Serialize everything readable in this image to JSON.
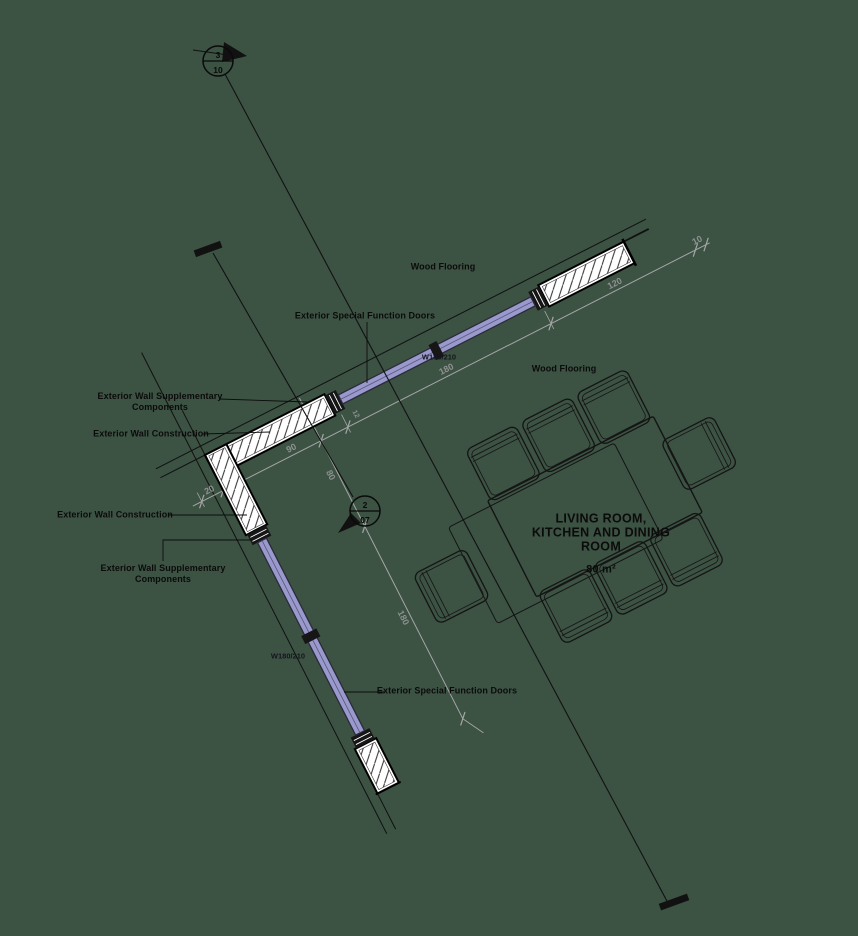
{
  "background": "#3c5243",
  "colors": {
    "background": "#3c5243",
    "door": "#9a99cd",
    "wall_fill": "#ffffff",
    "line": "#000000",
    "dimension": "#a6a6a6"
  },
  "room": {
    "title": [
      "LIVING ROOM,",
      "KITCHEN AND DINING",
      "ROOM"
    ],
    "area": "80 m²"
  },
  "labels": {
    "wood_flooring_top": "Wood Flooring",
    "wood_flooring_right": "Wood Flooring",
    "exterior_doors_top": "Exterior Special Function Doors",
    "exterior_doors_left": "Exterior Special Function Doors",
    "wall_supplementary_line1": "Exterior Wall Supplementary",
    "wall_supplementary_line2": "Components",
    "wall_construction": "Exterior Wall Construction",
    "door_spec_top": "W180/210",
    "door_spec_left": "W180/210"
  },
  "dimensions": {
    "wall_thickness": "20",
    "top_wall_segment": "90",
    "frame_width": "12",
    "top_door_width": "180",
    "right_wall_segment": "120",
    "end_offset": "10",
    "corner_offset": "80",
    "left_door_width": "180"
  },
  "section_markers": {
    "marker_3_10": {
      "detail": "3",
      "sheet": "10"
    },
    "marker_2_07": {
      "detail": "2",
      "sheet": "07"
    }
  }
}
